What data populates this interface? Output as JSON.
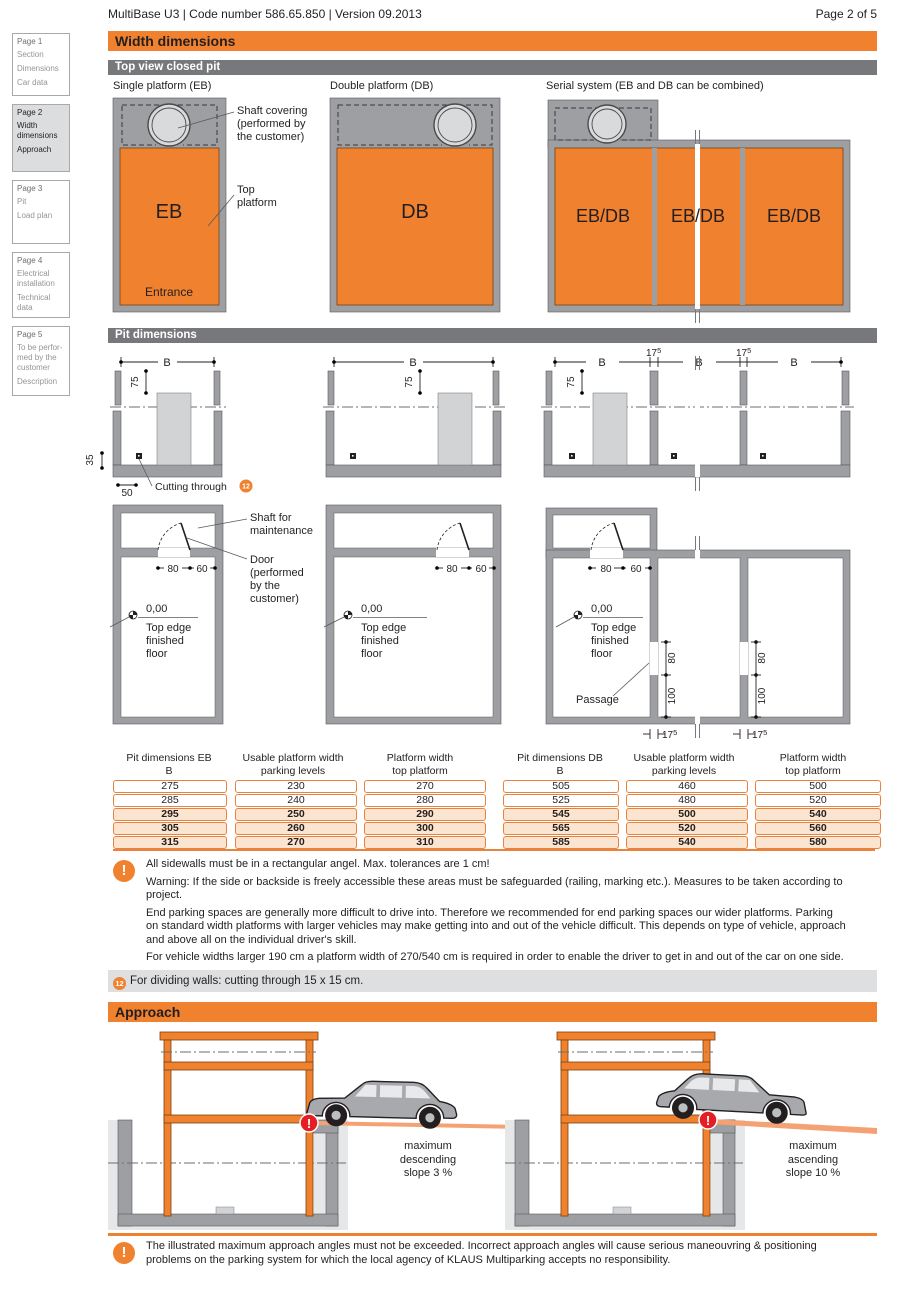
{
  "header": {
    "doc_title": "MultiBase U3 | Code number 586.65.850 | Version 09.2013",
    "page_indicator": "Page 2 of 5"
  },
  "sidebar": {
    "pages": [
      {
        "title": "Page 1",
        "items": [
          "Section",
          "Dimensions",
          "Car data"
        ]
      },
      {
        "title": "Page 2",
        "items": [
          "Width dimensions",
          "Approach"
        ]
      },
      {
        "title": "Page 3",
        "items": [
          "Pit",
          "Load plan"
        ]
      },
      {
        "title": "Page 4",
        "items": [
          "Electrical installation",
          "Technical data"
        ]
      },
      {
        "title": "Page 5",
        "items": [
          "To be perfor-med by the customer",
          "Description"
        ]
      }
    ]
  },
  "section_bars": {
    "width_dimensions": "Width dimensions",
    "top_view": "Top view closed pit",
    "pit_dimensions": "Pit dimensions",
    "approach": "Approach"
  },
  "top_view": {
    "single_title": "Single platform (EB)",
    "double_title": "Double platform (DB)",
    "serial_title": "Serial system (EB and DB can be combined)",
    "eb": "EB",
    "db": "DB",
    "ebdb": "EB/DB",
    "entrance": "Entrance",
    "shaft_covering_lines": [
      "Shaft covering",
      "(performed by",
      "the customer)"
    ],
    "top_platform_lines": [
      "Top",
      "platform"
    ]
  },
  "pit": {
    "b": "B",
    "d75": "75",
    "d35": "35",
    "d50": "50",
    "d80": "80",
    "d60": "60",
    "d100": "100",
    "d175_main": "17",
    "d175_sup": "5",
    "cutting_through": "Cutting through",
    "ref": "12",
    "shaft_maintenance_lines": [
      "Shaft for",
      "maintenance"
    ],
    "door_lines": [
      "Door",
      "(performed",
      "by the",
      "customer)"
    ],
    "zero": "0,00",
    "top_edge_lines": [
      "Top edge",
      "finished",
      "floor"
    ],
    "passage": "Passage"
  },
  "tables": {
    "eb": {
      "h1": [
        "Pit dimensions EB",
        "B"
      ],
      "h2": [
        "Usable platform width",
        "parking levels"
      ],
      "h3": [
        "Platform width",
        "top platform"
      ],
      "rows": [
        [
          "275",
          "230",
          "270"
        ],
        [
          "285",
          "240",
          "280"
        ],
        [
          "295",
          "250",
          "290"
        ],
        [
          "305",
          "260",
          "300"
        ],
        [
          "315",
          "270",
          "310"
        ]
      ]
    },
    "db": {
      "h1": [
        "Pit dimensions DB",
        "B"
      ],
      "h2": [
        "Usable platform width",
        "parking levels"
      ],
      "h3": [
        "Platform width",
        "top platform"
      ],
      "rows": [
        [
          "505",
          "460",
          "500"
        ],
        [
          "525",
          "480",
          "520"
        ],
        [
          "545",
          "500",
          "540"
        ],
        [
          "565",
          "520",
          "560"
        ],
        [
          "585",
          "540",
          "580"
        ]
      ]
    }
  },
  "notes": {
    "warning_mark": "!",
    "warnings": [
      "All sidewalls must be in a rectangular angel. Max. tolerances are 1 cm!",
      "Warning: If the side or backside is freely accessible these areas must be safeguarded (railing, marking etc.). Measures to be taken according to project.",
      "End parking spaces are generally more difficult to drive into. Therefore we recommended for end parking spaces our wider platforms. Parking on standard width platforms with larger vehicles may make getting into and out of the vehicle difficult. This depends on type of vehicle, approach and above all on the individual driver's skill.",
      "For vehicle widths larger 190 cm a platform width of 270/540 cm is required in order to enable the driver to get in and out of the car on one side."
    ],
    "dividing_ref": "12",
    "dividing_note": "For dividing walls: cutting through 15 x 15 cm."
  },
  "approach": {
    "descending_lines": [
      "maximum",
      "descending",
      "slope 3 %"
    ],
    "ascending_lines": [
      "maximum",
      "ascending",
      "slope 10 %"
    ],
    "alert_mark": "!",
    "warning": "The illustrated maximum approach angles must not be exceeded. Incorrect approach angles will cause serious maneouvring & positioning problems on the parking system for which the local agency of KLAUS Multiparking accepts no responsibility."
  },
  "colors": {
    "accent_orange": "#F0812F",
    "bar_gray": "#77787B",
    "wall_gray": "#9D9FA2",
    "table_border": "#E8823D",
    "row_highlight": "#FBE4D0",
    "warning_red": "#E31E24"
  }
}
